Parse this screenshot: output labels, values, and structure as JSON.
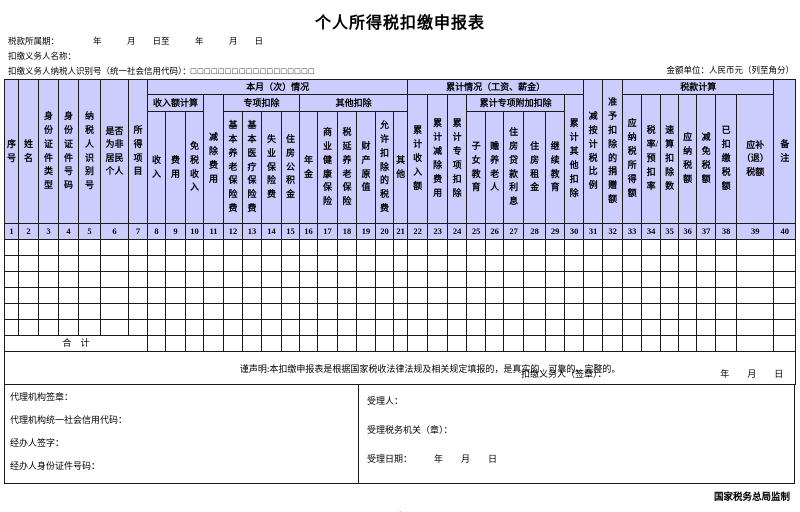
{
  "title": "个人所得税扣缴申报表",
  "meta": {
    "period_label": "税款所属期：",
    "period_value": "年　　　月　　日至　　　年　　　月　　日",
    "withholder_name_label": "扣缴义务人名称：",
    "withholder_id_label": "扣缴义务人纳税人识别号（统一社会信用代码）：",
    "withholder_id_boxes": "□□□□□□□□□□□□□□□□□□",
    "unit_note": "金额单位：人民币元（列至角分）"
  },
  "table": {
    "groups": {
      "current_month": "本月（次）情况",
      "income_calc": "收入额计算",
      "special_deduction": "专项扣除",
      "other_deduction": "其他扣除",
      "cumulative": "累计情况（工资、薪金）",
      "cumulative_additional": "累计专项附加扣除",
      "tax_calc": "税款计算"
    },
    "cols": [
      "序号",
      "姓名",
      "身份证件类型",
      "身份证件号码",
      "纳税人识别号",
      "是否为非居民个人",
      "所得项目",
      "收入",
      "费用",
      "免税收入",
      "减除费用",
      "基本养老保险费",
      "基本医疗保险费",
      "失业保险费",
      "住房公积金",
      "年金",
      "商业健康保险",
      "税延养老保险",
      "财产原值",
      "允许扣除的税费",
      "其他",
      "累计收入额",
      "累计减除费用",
      "累计专项扣除",
      "子女教育",
      "赡养老人",
      "住房贷款利息",
      "住房租金",
      "继续教育",
      "累计其他扣除",
      "减按计税比例",
      "准予扣除的捐赠额",
      "应纳税所得额",
      "税率/预扣率",
      "速算扣除数",
      "应纳税额",
      "减免税额",
      "已扣缴税额",
      "应补（退）税额",
      "备注"
    ],
    "col_numbers": [
      "1",
      "2",
      "3",
      "4",
      "5",
      "6",
      "7",
      "8",
      "9",
      "10",
      "11",
      "12",
      "13",
      "14",
      "15",
      "16",
      "17",
      "18",
      "19",
      "20",
      "21",
      "22",
      "23",
      "24",
      "25",
      "26",
      "27",
      "28",
      "29",
      "30",
      "31",
      "32",
      "33",
      "34",
      "35",
      "36",
      "37",
      "38",
      "39",
      "40"
    ],
    "summary_label": "合　计"
  },
  "declaration": {
    "text": "谨声明:本扣缴申报表是根据国家税收法律法规及相关规定填报的，是真实的、可靠的、完整的。",
    "signer_label": "扣缴义务人（签章）：",
    "date_placeholder": "年　　月　　日"
  },
  "footer": {
    "agency_seal_label": "代理机构签章：",
    "agency_code_label": "代理机构统一社会信用代码：",
    "agent_sign_label": "经办人签字：",
    "agent_id_label": "经办人身份证件号码：",
    "acceptor_label": "受理人：",
    "tax_authority_label": "受理税务机关（章）：",
    "accept_date_label": "受理日期：",
    "accept_date_value": "年　　月　　日"
  },
  "issuer": "国家税务总局监制",
  "page_number": "- 1 -"
}
